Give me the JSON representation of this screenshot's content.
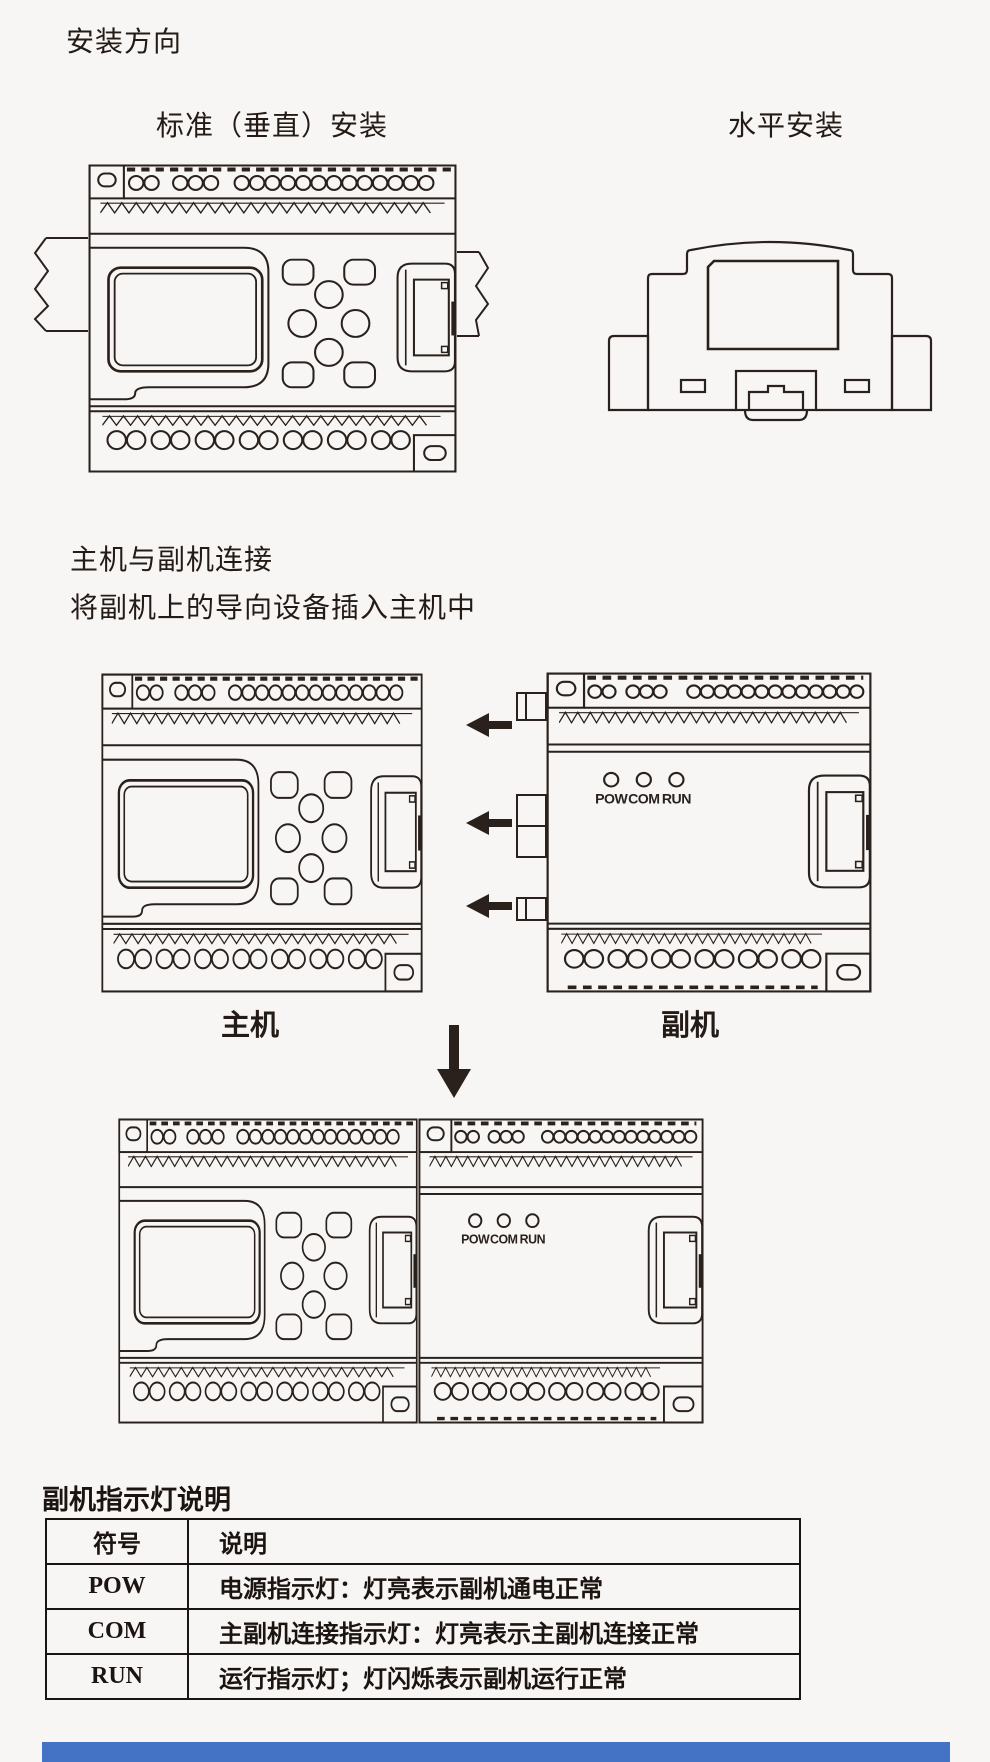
{
  "headings": {
    "title": "安装方向",
    "vertical_label": "标准（垂直）安装",
    "horizontal_label": "水平安装",
    "connect_title": "主机与副机连接",
    "connect_instruction": "将副机上的导向设备插入主机中",
    "main_unit_label": "主机",
    "sub_unit_label": "副机"
  },
  "leds": {
    "pow": "POW",
    "com": "COM",
    "run": "RUN"
  },
  "table": {
    "title": "副机指示灯说明",
    "headers": [
      "符号",
      "说明"
    ],
    "rows": [
      {
        "symbol": "POW",
        "description": "电源指示灯：灯亮表示副机通电正常"
      },
      {
        "symbol": "COM",
        "description": "主副机连接指示灯：灯亮表示主副机连接正常"
      },
      {
        "symbol": "RUN",
        "description": "运行指示灯；灯闪烁表示副机运行正常"
      }
    ]
  },
  "colors": {
    "ink": "#2a211c",
    "accent_blue": "#4472c4",
    "background": "#f7f6f4"
  }
}
